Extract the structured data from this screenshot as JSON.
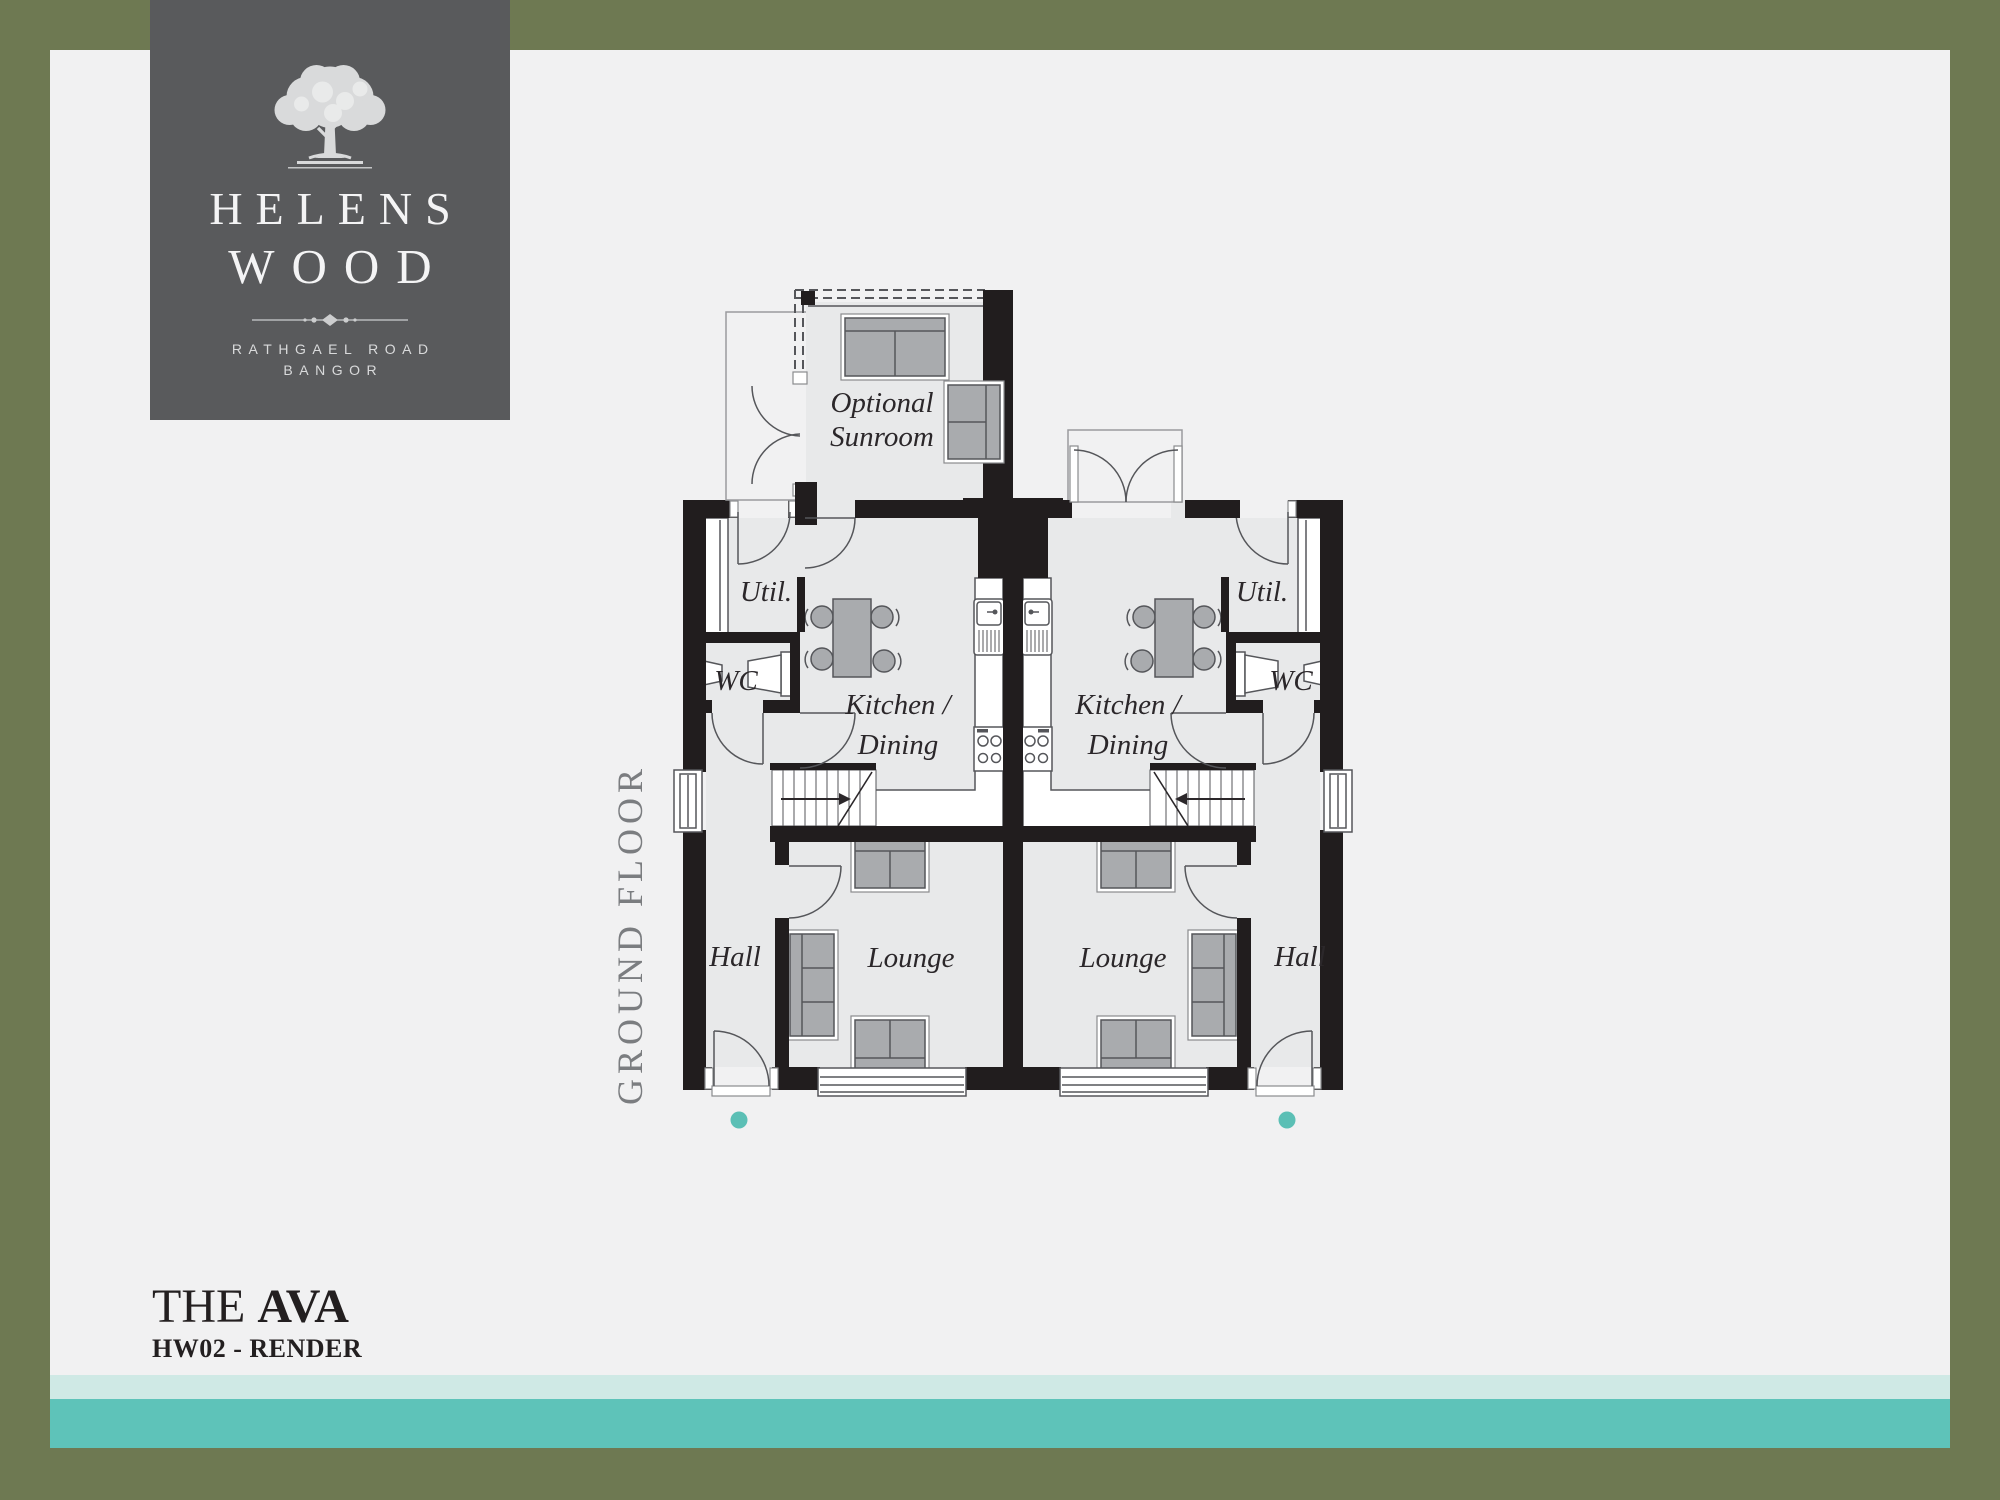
{
  "colors": {
    "border_olive": "#6e7952",
    "logo_panel_gray": "#595a5c",
    "background": "#f1f1f2",
    "stripe_light": "#cfe9e5",
    "stripe_teal": "#5ec3b9",
    "entrance_dot_teal": "#5bbfb5",
    "wall_black": "#211d1e",
    "room_fill_gray": "#e8e9ea",
    "floor_label_gray": "#7b7d80",
    "text_dark": "#231f20"
  },
  "logo": {
    "name_line1": "HELENS",
    "name_line2": "WOOD",
    "address_line1": "RATHGAEL ROAD",
    "address_line2": "BANGOR"
  },
  "plan": {
    "floor_label": "GROUND FLOOR",
    "sunroom_line1": "Optional",
    "sunroom_line2": "Sunroom",
    "left_unit": {
      "util": "Util.",
      "wc": "WC",
      "kitchen_line1": "Kitchen /",
      "kitchen_line2": "Dining",
      "hall": "Hall",
      "lounge": "Lounge"
    },
    "right_unit": {
      "util": "Util.",
      "wc": "WC",
      "kitchen_line1": "Kitchen /",
      "kitchen_line2": "Dining",
      "hall": "Hall",
      "lounge": "Lounge"
    }
  },
  "title_block": {
    "prefix": "THE ",
    "name": "AVA",
    "subtitle": "HW02 - RENDER"
  }
}
